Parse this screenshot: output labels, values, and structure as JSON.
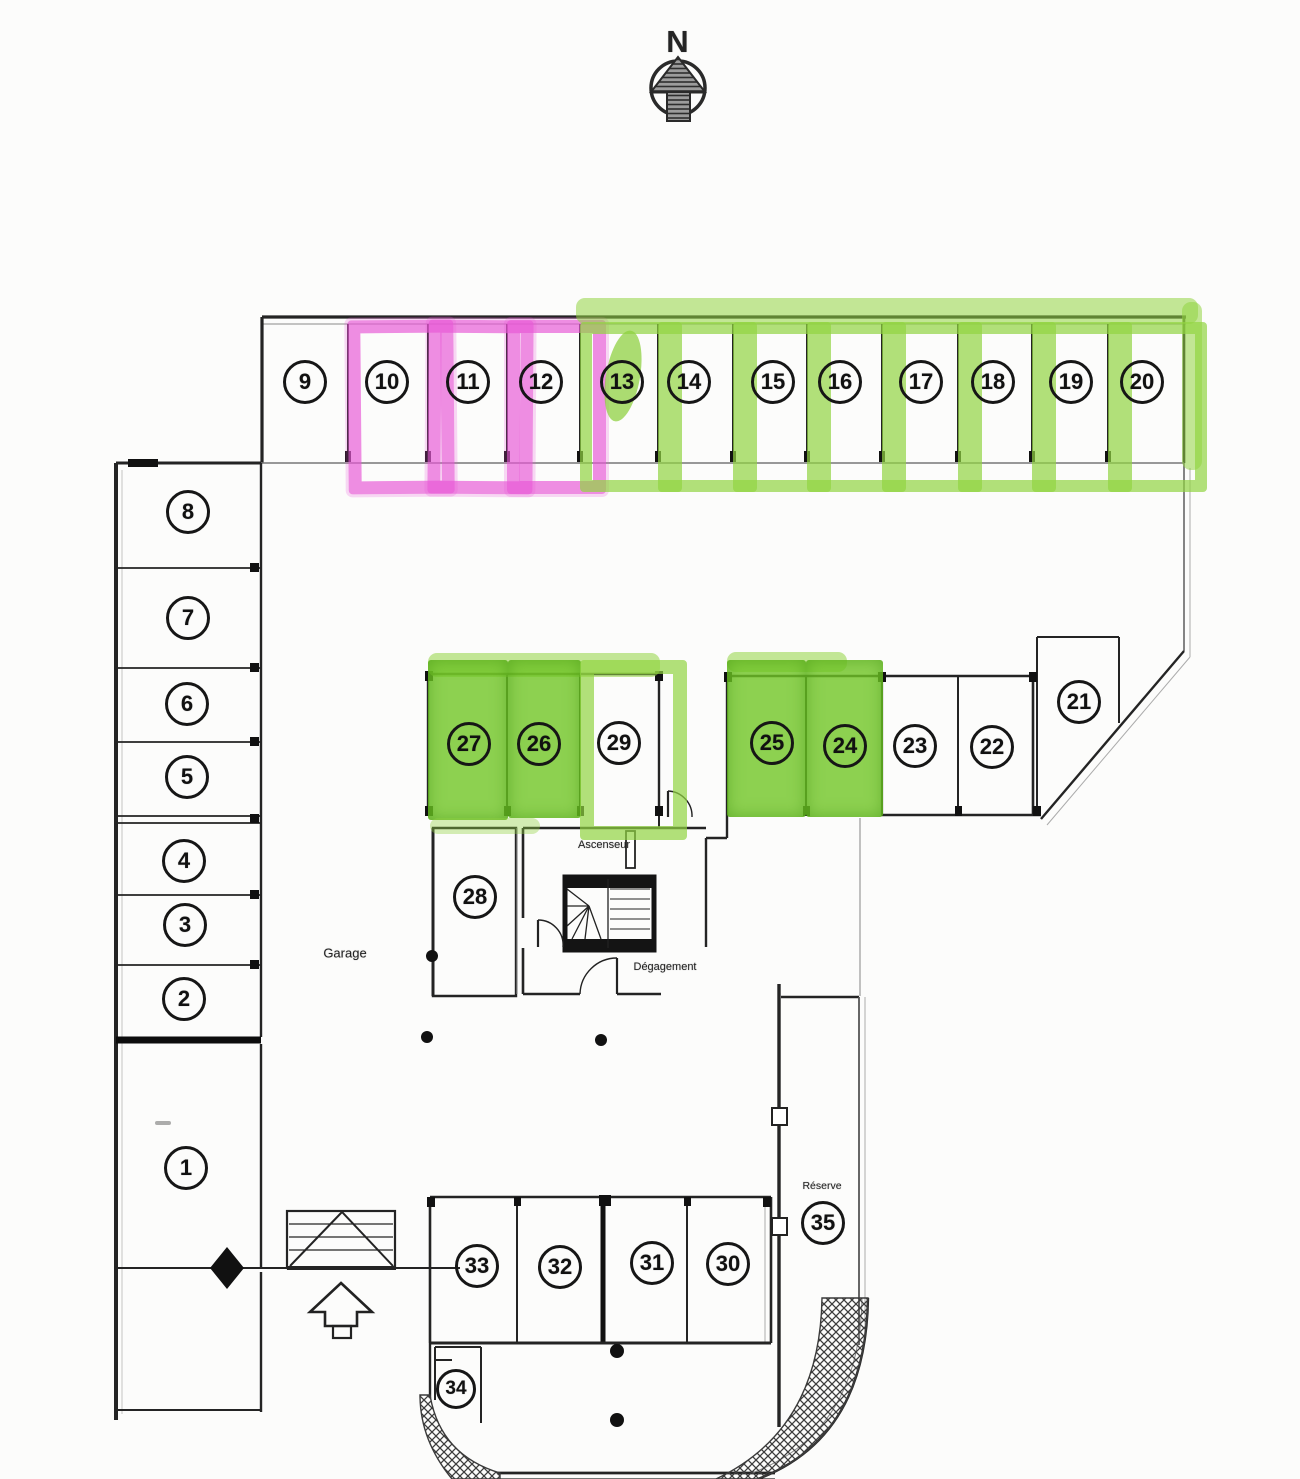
{
  "compass": {
    "north_label": "N"
  },
  "labels": {
    "garage": "Garage",
    "elevator": "Ascenseur",
    "clearance": "Dégagement",
    "reserve": "Réserve"
  },
  "colors": {
    "highlight_pink": "#e758d5",
    "highlight_green": "#8cd442",
    "line": "#242424"
  },
  "spaces": [
    {
      "number": "1",
      "highlight": "none"
    },
    {
      "number": "2",
      "highlight": "none"
    },
    {
      "number": "3",
      "highlight": "none"
    },
    {
      "number": "4",
      "highlight": "none"
    },
    {
      "number": "5",
      "highlight": "none"
    },
    {
      "number": "6",
      "highlight": "none"
    },
    {
      "number": "7",
      "highlight": "none"
    },
    {
      "number": "8",
      "highlight": "none"
    },
    {
      "number": "9",
      "highlight": "none"
    },
    {
      "number": "10",
      "highlight": "pink-marker-outline"
    },
    {
      "number": "11",
      "highlight": "pink-marker-outline"
    },
    {
      "number": "12",
      "highlight": "pink-marker-outline"
    },
    {
      "number": "13",
      "highlight": "green-marker-outline"
    },
    {
      "number": "14",
      "highlight": "green-marker-outline"
    },
    {
      "number": "15",
      "highlight": "green-marker-outline"
    },
    {
      "number": "16",
      "highlight": "green-marker-outline"
    },
    {
      "number": "17",
      "highlight": "green-marker-outline"
    },
    {
      "number": "18",
      "highlight": "green-marker-outline"
    },
    {
      "number": "19",
      "highlight": "green-marker-outline"
    },
    {
      "number": "20",
      "highlight": "green-marker-outline"
    },
    {
      "number": "21",
      "highlight": "none"
    },
    {
      "number": "22",
      "highlight": "none"
    },
    {
      "number": "23",
      "highlight": "none"
    },
    {
      "number": "24",
      "highlight": "green-marker-fill"
    },
    {
      "number": "25",
      "highlight": "green-marker-fill"
    },
    {
      "number": "26",
      "highlight": "green-marker-fill"
    },
    {
      "number": "27",
      "highlight": "green-marker-fill"
    },
    {
      "number": "28",
      "highlight": "none"
    },
    {
      "number": "29",
      "highlight": "green-marker-outline"
    },
    {
      "number": "30",
      "highlight": "none"
    },
    {
      "number": "31",
      "highlight": "none"
    },
    {
      "number": "32",
      "highlight": "none"
    },
    {
      "number": "33",
      "highlight": "none"
    },
    {
      "number": "34",
      "highlight": "none"
    },
    {
      "number": "35",
      "highlight": "none"
    }
  ]
}
